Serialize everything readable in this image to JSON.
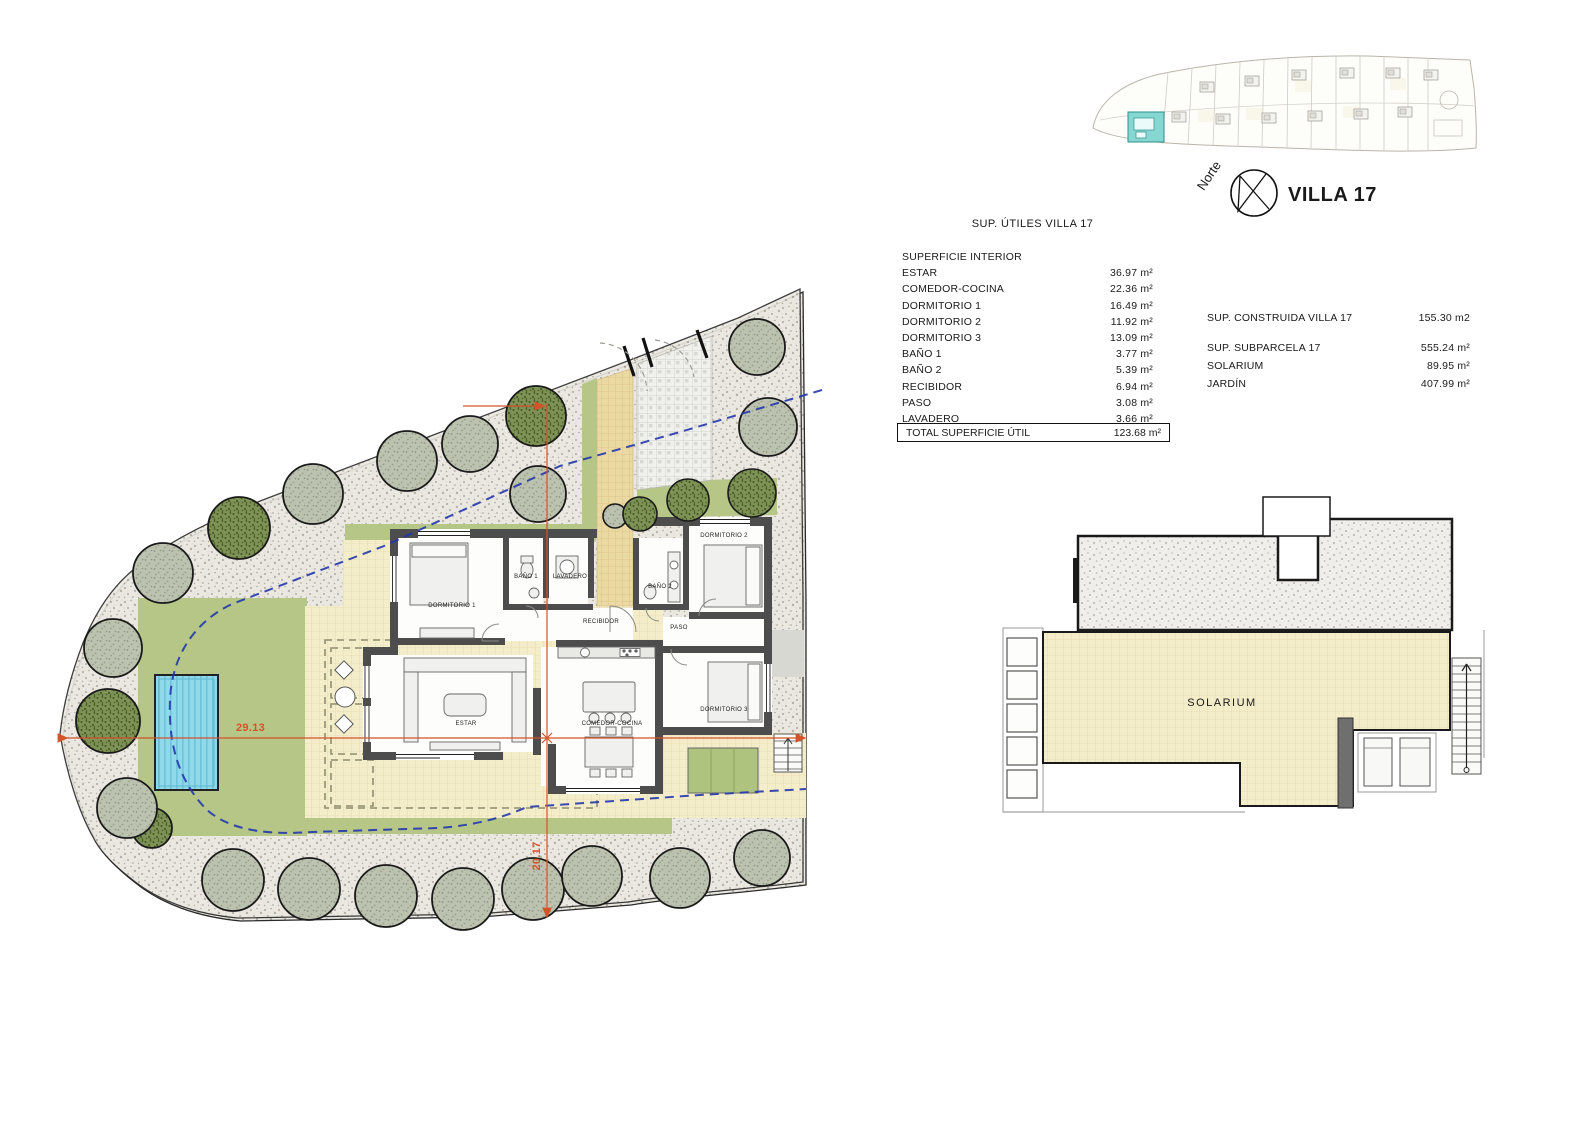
{
  "drawing": {
    "north_label": "Norte",
    "villa_title": "VILLA 17"
  },
  "areas_table": {
    "title": "SUP. ÚTILES VILLA 17",
    "header": "SUPERFICIE INTERIOR",
    "rows": [
      {
        "label": "ESTAR",
        "value": "36.97 m²"
      },
      {
        "label": "COMEDOR-COCINA",
        "value": "22.36 m²"
      },
      {
        "label": "DORMITORIO 1",
        "value": "16.49 m²"
      },
      {
        "label": "DORMITORIO 2",
        "value": "11.92 m²"
      },
      {
        "label": "DORMITORIO 3",
        "value": "13.09 m²"
      },
      {
        "label": "BAÑO 1",
        "value": "3.77 m²"
      },
      {
        "label": "BAÑO 2",
        "value": "5.39 m²"
      },
      {
        "label": "RECIBIDOR",
        "value": "6.94 m²"
      },
      {
        "label": "PASO",
        "value": "3.08 m²"
      },
      {
        "label": "LAVADERO",
        "value": "3.66 m²"
      }
    ],
    "total": {
      "label": "TOTAL SUPERFICIE ÚTIL",
      "value": "123.68 m²"
    }
  },
  "summary_table": {
    "rows": [
      {
        "label": "SUP. CONSTRUIDA VILLA 17",
        "value": "155.30 m2"
      },
      {
        "label": "SUP. SUBPARCELA 17",
        "value": "555.24 m²"
      },
      {
        "label": "SOLARIUM",
        "value": "89.95 m²"
      },
      {
        "label": "JARDÍN",
        "value": "407.99 m²"
      }
    ]
  },
  "floor_plan": {
    "rooms": [
      {
        "label": "DORMITORIO 1"
      },
      {
        "label": "BAÑO 1"
      },
      {
        "label": "LAVADERO"
      },
      {
        "label": "RECIBIDOR"
      },
      {
        "label": "BAÑO 2"
      },
      {
        "label": "DORMITORIO 2"
      },
      {
        "label": "PASO"
      },
      {
        "label": "DORMITORIO 3"
      },
      {
        "label": "ESTAR"
      },
      {
        "label": "COMEDOR-COCINA"
      }
    ],
    "dimensions": {
      "width": "29.13",
      "depth": "20.17"
    }
  },
  "roof_plan": {
    "label": "SOLARIUM"
  },
  "colors": {
    "lawn": "#b5c686",
    "pool": "#8fd9eb",
    "terrace": "#f4edca",
    "path_tan": "#ead9a2",
    "setback_line_blue": "#2436ad",
    "dimension_orange": "#d4532a",
    "site_map_highlight": "#86d7d2",
    "wall_gray": "#4d4d4d"
  }
}
